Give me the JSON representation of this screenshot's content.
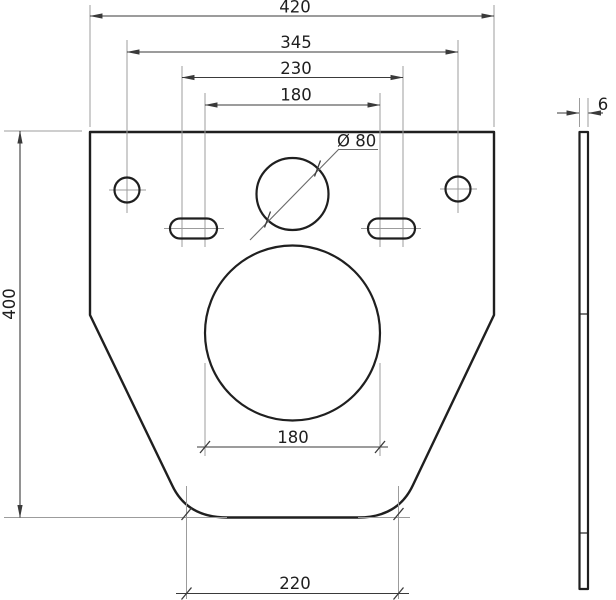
{
  "colors": {
    "outline": "#1f1f1f",
    "dim": "#3a3a3a",
    "ext": "#9c9c9c",
    "leader": "#6a6a6a",
    "text": "#1f1f1f"
  },
  "dims": {
    "overall_width": "420",
    "hole_spacing": "345",
    "bolt_spacing_wide": "230",
    "bolt_spacing_narrow": "180",
    "flush_hole_diameter": "Ø 80",
    "drain_circle_width": "180",
    "bottom_width": "220",
    "overall_height": "400",
    "thickness": "6"
  }
}
